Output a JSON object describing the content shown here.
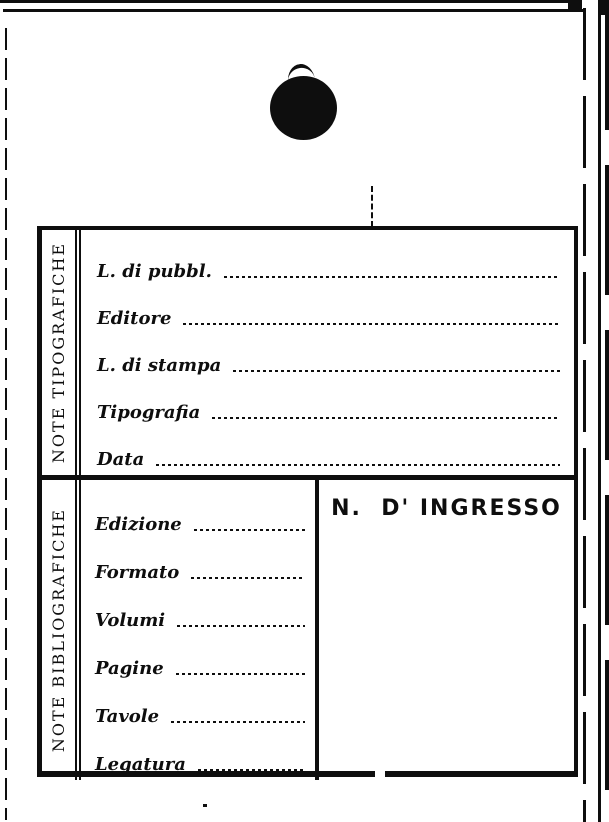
{
  "page": {
    "kind": "scanned library accession card (blank form)",
    "colors": {
      "paper": "#ffffff",
      "ink": "#0e0e0e"
    },
    "icons": {
      "hole_punch": "filled-ellipse",
      "pointer": "dashed-vertical-line"
    }
  },
  "card": {
    "tipografiche": {
      "side_label": "NOTE TIPOGRAFICHE",
      "fields": [
        {
          "label": "L. di pubbl."
        },
        {
          "label": "Editore"
        },
        {
          "label": "L. di stampa"
        },
        {
          "label": "Tipografia"
        },
        {
          "label": "Data"
        }
      ]
    },
    "bibliografiche": {
      "side_label": "NOTE BIBLIOGRAFICHE",
      "fields": [
        {
          "label": "Edizione"
        },
        {
          "label": "Formato"
        },
        {
          "label": "Volumi"
        },
        {
          "label": "Pagine"
        },
        {
          "label": "Tavole"
        },
        {
          "label": "Legatura"
        }
      ],
      "ingresso_title": "N.  D' INGRESSO"
    }
  }
}
